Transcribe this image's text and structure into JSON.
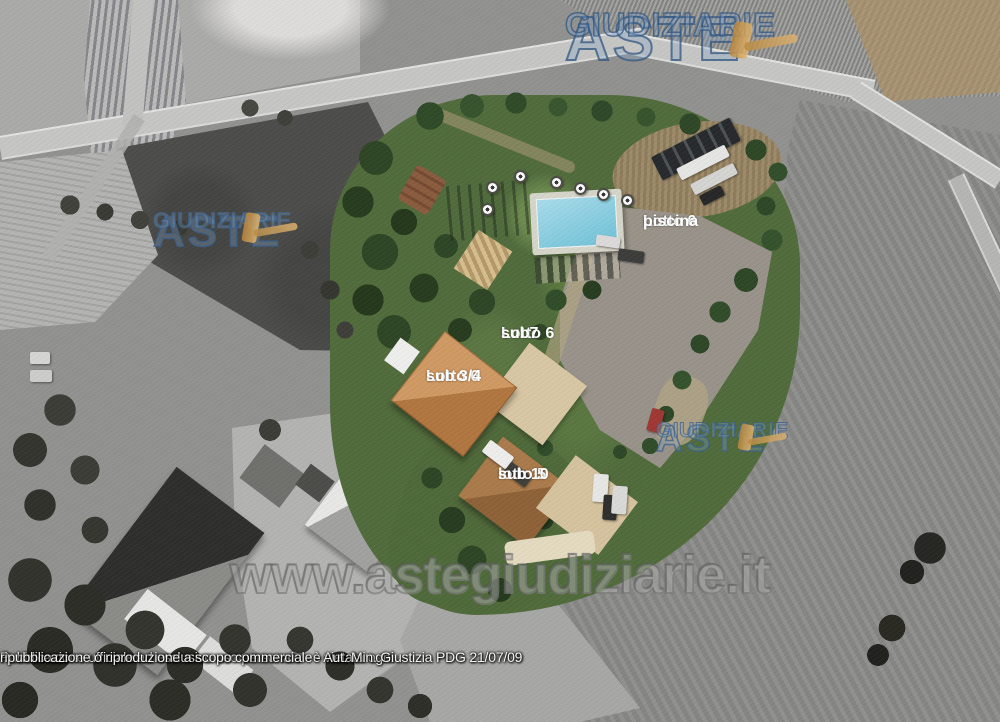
{
  "watermarks": {
    "brand_line1": "ASTE",
    "brand_line2": "GIUDIZIARIE",
    "url": "www.astegiudiziarie.it"
  },
  "labels": {
    "pool": {
      "line1": "Lotto 6",
      "line2": "piscina"
    },
    "sub7": {
      "line1": "Lotto 6",
      "line2": "sub7"
    },
    "sub34": {
      "line1": "Lotto 6",
      "line2": "sub 3/4"
    },
    "sub10": {
      "line1": "lotto 5",
      "line2": "sub 10"
    }
  },
  "footer": {
    "line1": "Pubblicazione ufficiale ad esclusivo uso personale - è vietata ogni",
    "line2": "ripubblicazione o riproduzione a scopo commerciale - Aut. Min. Giustizia PDG 21/07/09"
  },
  "colors": {
    "brand_blue": "#3f6291",
    "gavel_tan": "#c89a5c",
    "pool_blue": "#8ed2e4",
    "lawn_green": "#4f6a39"
  }
}
